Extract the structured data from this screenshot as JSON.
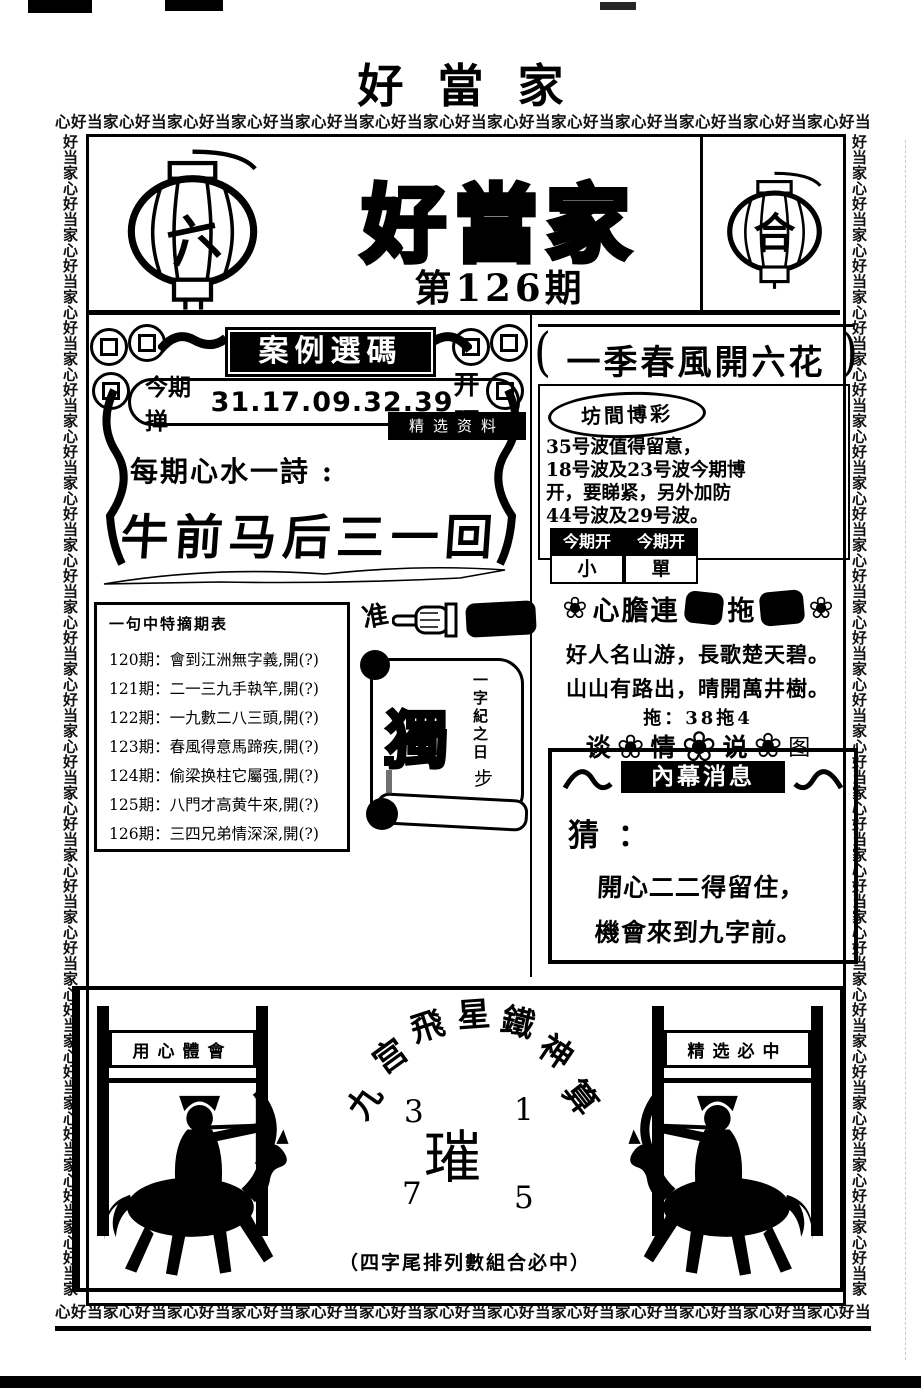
{
  "colors": {
    "ink": "#000000",
    "paper": "#ffffff"
  },
  "page": {
    "top_title": "好當家",
    "border": {
      "horizontal": "心好当家心好当家心好当家心好当家心好当家心好当家心好当家心好当家心好当家心好当家心好当家心好当家心好当家",
      "vertical": "好当家心好当家心好当家心好当家心好当家心好当家心好当家心好当家心好当家心好当家心好当家心好当家心好当家心好当家心好当家心好当家心好当家心好当家心好当家心"
    }
  },
  "header": {
    "lantern_left_char": "六",
    "lantern_right_char": "合",
    "masthead": "好當家",
    "issue": "第126期"
  },
  "left_column": {
    "section_title": "案例選碼",
    "this_issue": {
      "label": "今期掸",
      "numbers": "31.17.09.32.39",
      "suffix": "开旺"
    },
    "tag": "精选资料",
    "verse_label": "每期心水一詩 :",
    "verse": "牛前马后三一回",
    "pointer_char": "准",
    "scroll": {
      "big_char": "獨",
      "side_text": "一字紀之日",
      "step_char": "步"
    },
    "issues_box": {
      "title": "一句中特摘期表",
      "items": [
        "120期：會到江洲無字義,開(?)",
        "121期：二一三九手執竿,開(?)",
        "122期：一九數二八三頭,開(?)",
        "123期：春風得意馬蹄疾,開(?)",
        "124期：偷梁换柱它屬强,開(?)",
        "125期：八門才高黄牛來,開(?)",
        "126期：三四兄弟情深深,開(?)"
      ]
    }
  },
  "right_column": {
    "header": "一季春風開六花",
    "badge": "坊間博彩",
    "tips": [
      "35号波值得留意，",
      "18号波及23号波今期博",
      "开，要睇紧，另外加防",
      "44号波及29号波。"
    ],
    "table": {
      "headers": [
        "今期开",
        "今期开"
      ],
      "values": [
        "小",
        "單"
      ]
    },
    "smudge_header": {
      "part1": "心膽連",
      "part2": "拖"
    },
    "poem": [
      "好人名山游，長歌楚天碧。",
      "山山有路出，晴開萬井樹。"
    ],
    "dan_line": "拖：38拖4",
    "flower_glyph": "❀",
    "flower_row": [
      "谈",
      "情",
      "说",
      "图"
    ],
    "insider": {
      "title": "內幕消息",
      "guess_label": "猜 ：",
      "lines": [
        "開心二二得留住，",
        "機會來到九字前。"
      ]
    }
  },
  "bottom": {
    "arc_chars": [
      "九",
      "宫",
      "飛",
      "星",
      "鐵",
      "神",
      "算"
    ],
    "grid": {
      "top_left": "3",
      "top_right": "1",
      "center": "璀",
      "bottom_left": "7",
      "bottom_right": "5"
    },
    "left_plaque": "用心體會",
    "right_plaque": "精选必中",
    "footer_note": "（四字尾排列數組合必中）"
  }
}
